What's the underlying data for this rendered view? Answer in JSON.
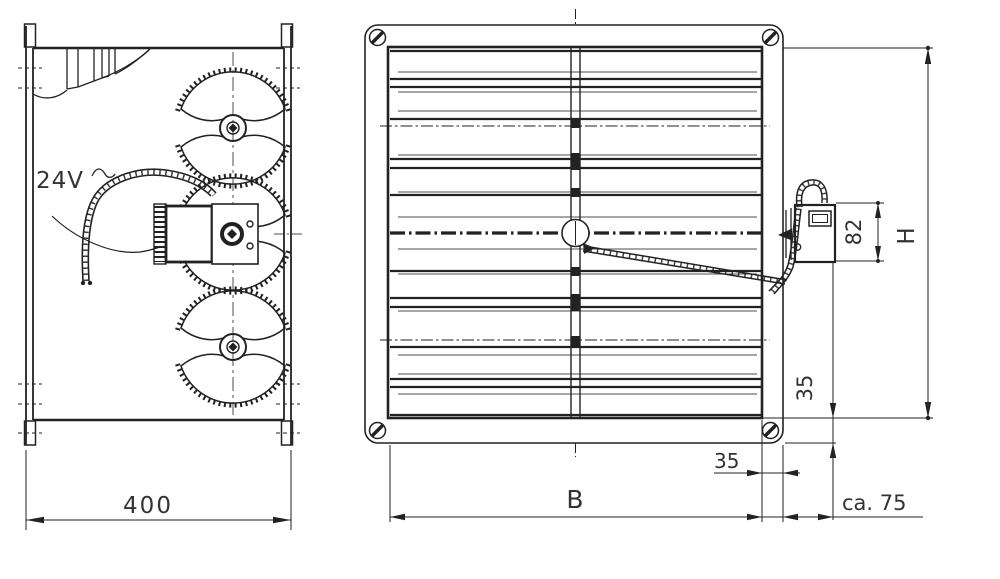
{
  "drawing": {
    "views": {
      "side": {
        "voltage_label": "24V"
      },
      "front": {}
    },
    "dimensions": {
      "side_width": {
        "label": "400",
        "orientation": "horizontal"
      },
      "opening_width": {
        "label": "B",
        "orientation": "horizontal"
      },
      "opening_height": {
        "label": "H",
        "orientation": "vertical"
      },
      "actuator_height": {
        "label": "82",
        "orientation": "vertical"
      },
      "flange_right": {
        "label": "35",
        "orientation": "horizontal"
      },
      "flange_bottom": {
        "label": "35",
        "orientation": "vertical"
      },
      "actuator_projection": {
        "label": "ca. 75",
        "orientation": "horizontal"
      }
    },
    "icons": [
      "corner-screw-icon",
      "gear-sector-icon",
      "actuator-icon",
      "twisted-cable-icon"
    ],
    "colors": {
      "ink": "#222222",
      "paper": "#ffffff",
      "text": "#333333"
    }
  }
}
